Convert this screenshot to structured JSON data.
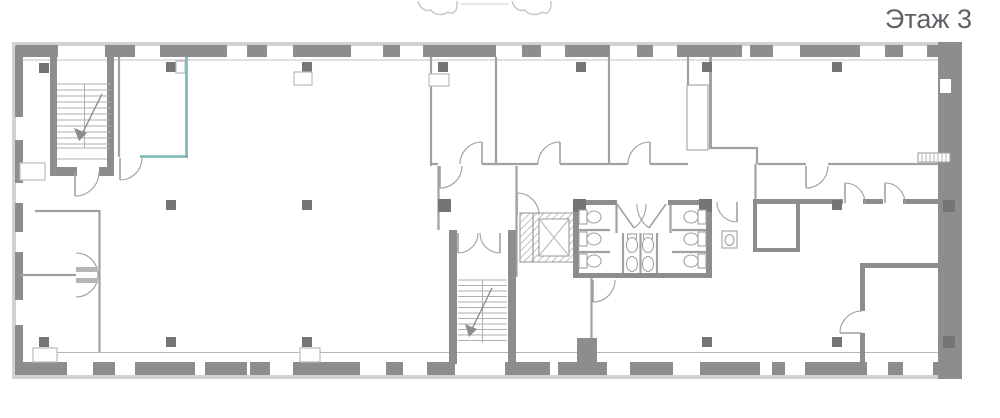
{
  "page": {
    "floor_label": "Этаж 3"
  },
  "colors": {
    "background": "#ffffff",
    "wall_dark": "#8d8d8f",
    "wall_light": "#d2d2d4",
    "column_dark": "#757577",
    "line_medium": "#9fa1a3",
    "line_light": "#b8babc",
    "accent_teal": "#7cb6b7",
    "text_gray": "#5f6367",
    "sketch_light": "#c6c8ca"
  },
  "plan": {
    "elements": [
      "outer-walls-with-windows",
      "grid-columns",
      "staircase-northwest",
      "staircase-central",
      "elevator-shaft",
      "wc-block-toilet-stalls",
      "door-swings",
      "radiator",
      "teal-accent-room",
      "sketch-fragment-top"
    ]
  }
}
